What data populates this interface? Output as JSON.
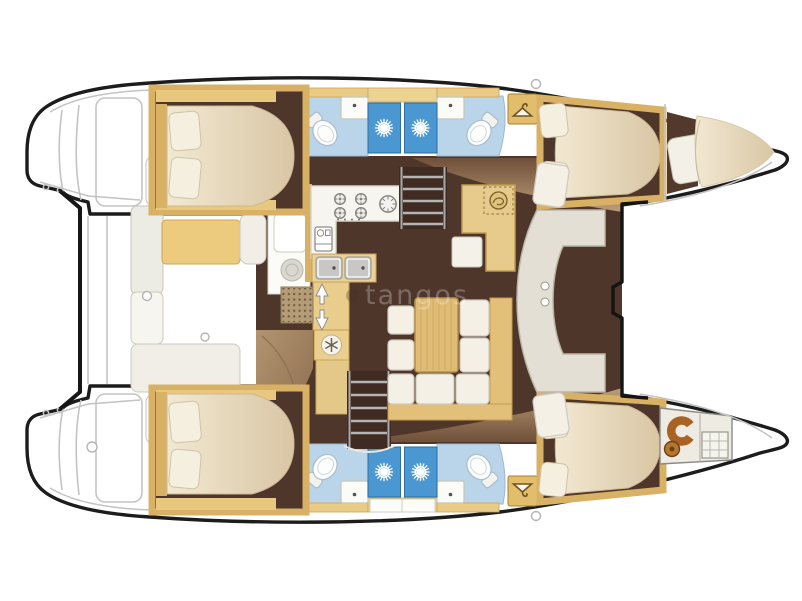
{
  "document": {
    "type": "catamaran-interior-floor-plan",
    "description": "Top-view layout of a 4-cabin sailing catamaran, bows to the right"
  },
  "watermark": {
    "logo": "round-logo-icon",
    "text": "tangos"
  },
  "palette": {
    "hull_outline": "#1c1c1c",
    "deck_line": "#c4c4c4",
    "wood_gold": "#d9b164",
    "wood_gold_dark": "#b5883c",
    "wood_shelf": "#e8c87e",
    "floor_dark": "#4e362a",
    "floor_tan": "#9a7b5f",
    "mattress_light": "#f2e8d2",
    "mattress_dark": "#d9c6a4",
    "cushion_white": "#f4f0e6",
    "cushion_yellow": "#eccb7f",
    "shower_blue": "#4a97d2",
    "bath_blue": "#bad4ea",
    "sofa_grey": "#e4dfd4",
    "accent_orange": "#a96223"
  },
  "icons": {
    "shower-rose-icon": "white radial starburst in blue shower stall (x4)",
    "clothes-hanger-icon": "hanger in wardrobe locker (x4)",
    "snowflake-icon": "fridge-freezer snowflake in galley",
    "stove-burner-icon": "four gas burners on galley counter",
    "extractor-icon": "segmented round burner beside stove",
    "oven-icon": "small oven front on galley counter",
    "sink-icon": "basin with tap dot (x4 bathrooms, x2 galley)",
    "toilet-icon": "oval bowl with cistern (x4)",
    "stairs-arrow-icon": "white up-down arrows at companionway mat",
    "nav-instrument-icon": "round dial on chart table",
    "crew-toilet-icon": "orange horseshoe seat in starboard forepeak",
    "deck-hatch-icon": "small round deck hatches/cleats"
  },
  "areas": [
    "port-stern-platform",
    "starboard-stern-platform",
    "aft-crossbeam",
    "cockpit-bench-port",
    "cockpit-bench-starboard",
    "cockpit-wet-bar",
    "galley",
    "companionway-port",
    "companionway-starboard",
    "salon-dining",
    "nav-station",
    "forward-sofa",
    "port-aft-cabin",
    "port-forward-cabin",
    "starboard-aft-cabin",
    "starboard-forward-cabin",
    "bathroom-port-aft",
    "bathroom-port-forward",
    "bathroom-starboard-aft",
    "bathroom-starboard-forward",
    "shower-port-aft",
    "shower-port-forward",
    "shower-starboard-aft",
    "shower-starboard-forward",
    "port-forepeak-berth",
    "starboard-forepeak-head"
  ]
}
